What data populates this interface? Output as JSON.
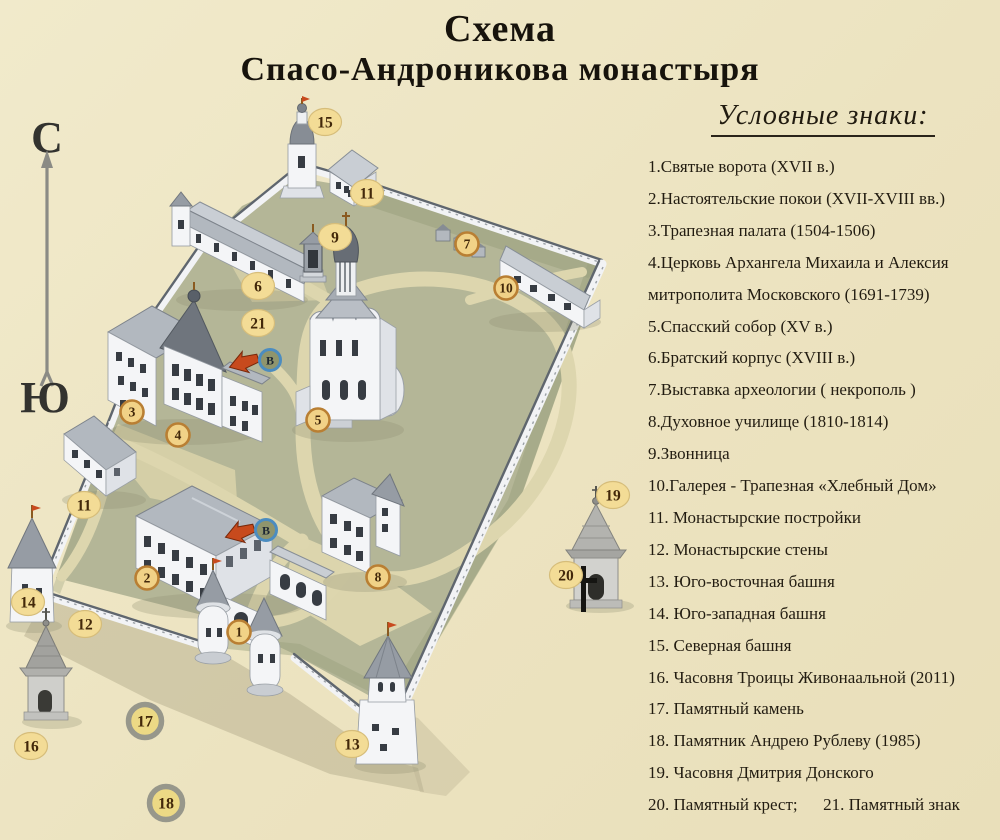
{
  "title": {
    "line1": "Схема",
    "line2": "Спасо-Андроникова монастыря"
  },
  "legend": {
    "title": "Условные знаки:",
    "items": [
      "1.Святые ворота (XVII в.)",
      "2.Настоятельские покои (XVII-XVIII вв.)",
      "3.Трапезная палата (1504-1506)",
      "4.Церковь Архангела Михаила и Алексия митрополита Московского (1691-1739)",
      "5.Спасский собор (XV в.)",
      "6.Братский корпус (XVIII в.)",
      "7.Выставка археологии ( некрополь )",
      "8.Духовное училище (1810-1814)",
      "9.Звонница",
      "10.Галерея - Трапезная «Хлебный Дом»",
      "11. Монастырские постройки",
      "12. Монастырские стены",
      "13. Юго-восточная башня",
      "14. Юго-западная башня",
      "15. Северная башня",
      "16. Часовня Троицы Живонаальной (2011)",
      "17. Памятный камень",
      "18. Памятник Андрею Рублеву (1985)",
      "19. Часовня Дмитрия Донского",
      "20. Памятный крест;      21. Памятный знак"
    ]
  },
  "map": {
    "compass": {
      "north": "С",
      "south": "Ю"
    },
    "colors": {
      "background": "#ece3c0",
      "courtyard": "#b4b697",
      "path": "#ddd6ae",
      "wall_white": "#f2f3f5",
      "marker_fill": "#f3dc96",
      "marker_ring_orange": "#b97f33",
      "marker_text": "#42280a",
      "entrance_ring_blue": "#4b8cc0",
      "arrow_red": "#c74a1d"
    },
    "markers": [
      {
        "n": "1",
        "x": 239,
        "y": 632,
        "ring": "orange"
      },
      {
        "n": "2",
        "x": 147,
        "y": 578,
        "ring": "orange"
      },
      {
        "n": "3",
        "x": 132,
        "y": 412,
        "ring": "orange"
      },
      {
        "n": "4",
        "x": 178,
        "y": 435,
        "ring": "orange"
      },
      {
        "n": "5",
        "x": 318,
        "y": 420,
        "ring": "orange"
      },
      {
        "n": "6",
        "x": 258,
        "y": 286,
        "ring": "plain"
      },
      {
        "n": "7",
        "x": 467,
        "y": 244,
        "ring": "orange"
      },
      {
        "n": "8",
        "x": 378,
        "y": 577,
        "ring": "orange"
      },
      {
        "n": "9",
        "x": 335,
        "y": 237,
        "ring": "plain"
      },
      {
        "n": "10",
        "x": 506,
        "y": 288,
        "ring": "orange"
      },
      {
        "n": "11",
        "x": 367,
        "y": 193,
        "ring": "plain"
      },
      {
        "n": "11",
        "x": 84,
        "y": 505,
        "ring": "plain"
      },
      {
        "n": "12",
        "x": 85,
        "y": 624,
        "ring": "plain"
      },
      {
        "n": "13",
        "x": 352,
        "y": 744,
        "ring": "plain"
      },
      {
        "n": "14",
        "x": 28,
        "y": 602,
        "ring": "plain"
      },
      {
        "n": "15",
        "x": 325,
        "y": 122,
        "ring": "plain"
      },
      {
        "n": "16",
        "x": 31,
        "y": 746,
        "ring": "plain"
      },
      {
        "n": "17",
        "x": 145,
        "y": 721,
        "ring": "gray"
      },
      {
        "n": "18",
        "x": 166,
        "y": 803,
        "ring": "gray"
      },
      {
        "n": "19",
        "x": 613,
        "y": 495,
        "ring": "plain"
      },
      {
        "n": "20",
        "x": 566,
        "y": 575,
        "ring": "plain"
      },
      {
        "n": "21",
        "x": 258,
        "y": 323,
        "ring": "plain"
      }
    ],
    "entrances": [
      {
        "label": "В",
        "x": 270,
        "y": 360
      },
      {
        "label": "В",
        "x": 266,
        "y": 530
      }
    ],
    "cross_glyph": "†"
  }
}
